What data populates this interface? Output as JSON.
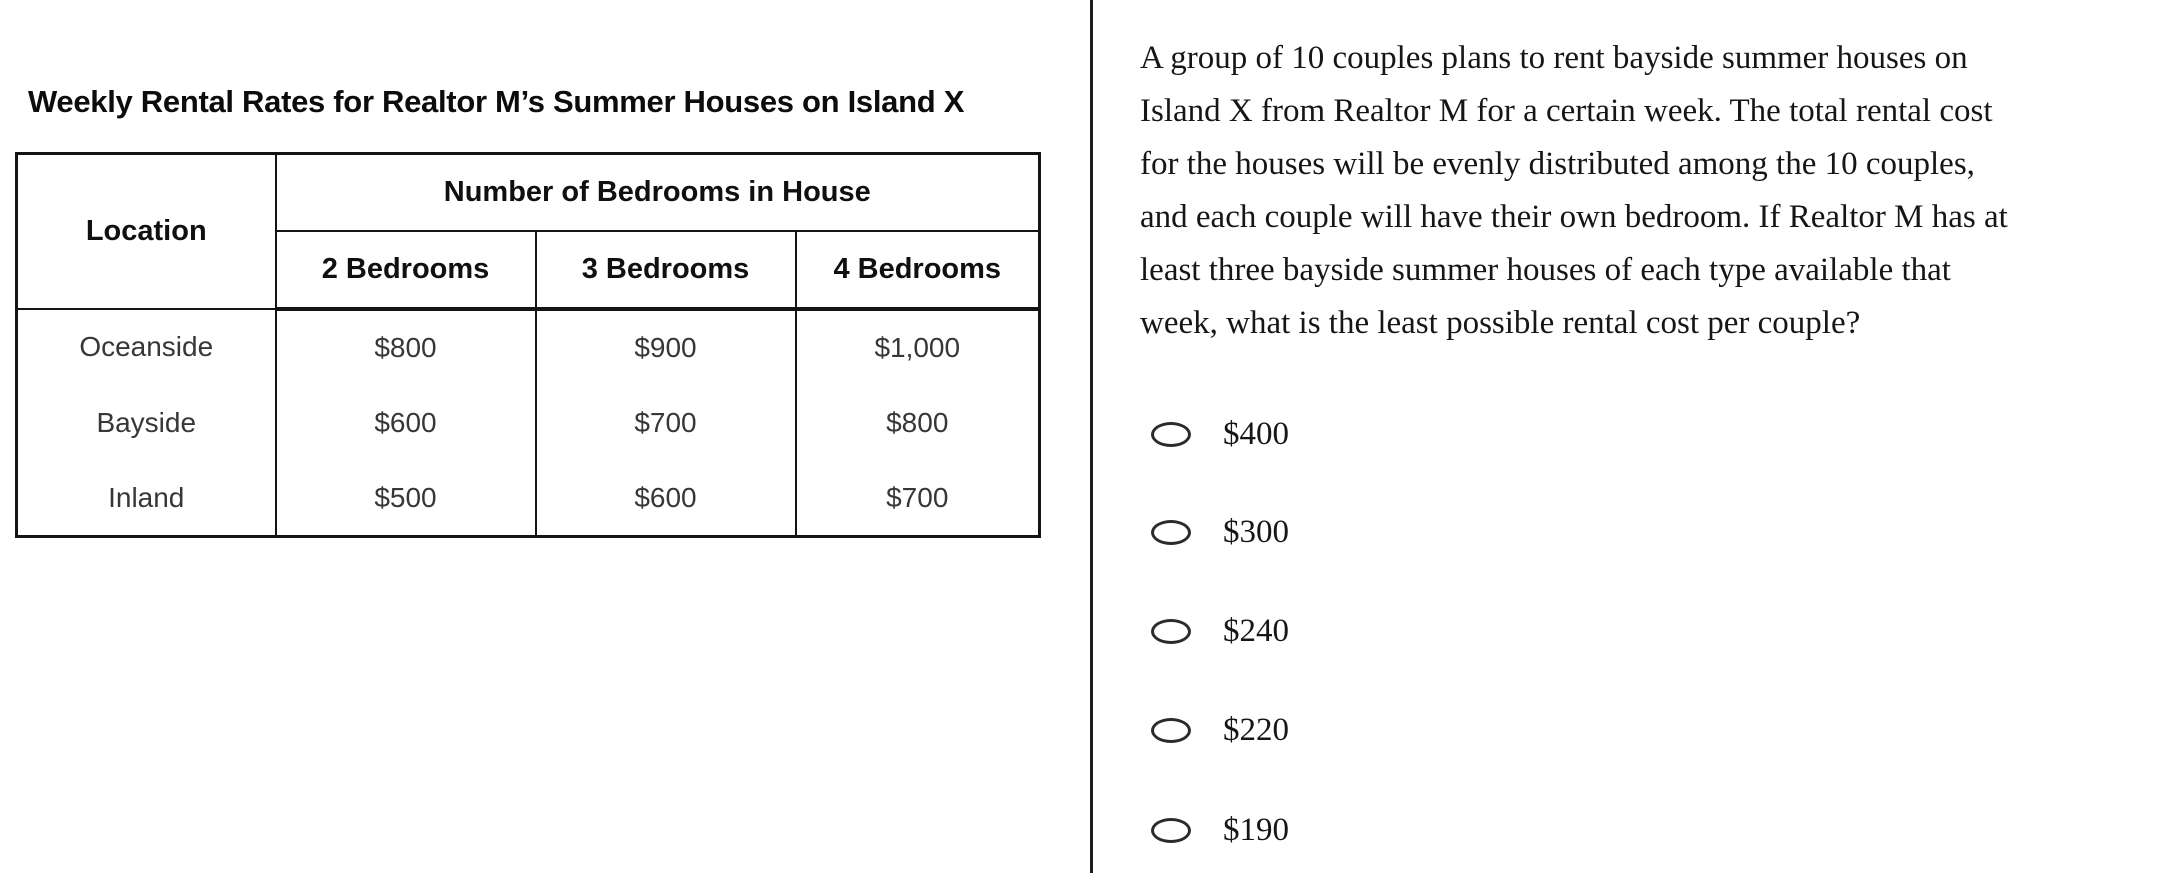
{
  "left_panel": {
    "table_title": "Weekly Rental Rates for Realtor M’s Summer Houses on Island X",
    "table": {
      "corner_header": "Location",
      "group_header": "Number of Bedrooms in House",
      "column_headers": [
        "2 Bedrooms",
        "3 Bedrooms",
        "4 Bedrooms"
      ],
      "rows": [
        {
          "location": "Oceanside",
          "values": [
            "$800",
            "$900",
            "$1,000"
          ]
        },
        {
          "location": "Bayside",
          "values": [
            "$600",
            "$700",
            "$800"
          ]
        },
        {
          "location": "Inland",
          "values": [
            "$500",
            "$600",
            "$700"
          ]
        }
      ]
    }
  },
  "right_panel": {
    "question_text": "A group of 10 couples plans to rent bayside summer houses on Island X from Realtor M for a certain week. The total rental cost for the houses will be evenly distributed among the 10 couples, and each couple will have their own bedroom. If Realtor M has at least three bayside summer houses of each type available that week, what is the least possible rental cost per couple?",
    "question_lines": [
      "A group of 10 couples plans to rent bayside summer houses on",
      "Island X from Realtor M for a certain week. The total rental cost",
      "for the houses will be evenly distributed among the 10 couples,",
      "and each couple will have their own bedroom. If Realtor M has at",
      "least three bayside summer houses of each type available that",
      "week, what is the least possible rental cost per couple?"
    ],
    "options": [
      {
        "label": "$400",
        "selected": false
      },
      {
        "label": "$300",
        "selected": false
      },
      {
        "label": "$240",
        "selected": false
      },
      {
        "label": "$220",
        "selected": false
      },
      {
        "label": "$190",
        "selected": false
      }
    ]
  },
  "chart_data": {
    "type": "table",
    "title": "Weekly Rental Rates for Realtor M’s Summer Houses on Island X",
    "row_header": "Location",
    "column_group": "Number of Bedrooms in House",
    "columns": [
      "2 Bedrooms",
      "3 Bedrooms",
      "4 Bedrooms"
    ],
    "rows": [
      {
        "location": "Oceanside",
        "values": [
          800,
          900,
          1000
        ]
      },
      {
        "location": "Bayside",
        "values": [
          600,
          700,
          800
        ]
      },
      {
        "location": "Inland",
        "values": [
          500,
          600,
          700
        ]
      }
    ]
  },
  "colors": {
    "background": "#ffffff",
    "text": "#161616",
    "table_border": "#141414",
    "divider": "#1d1d1d",
    "radio_outline": "#2b2b2b"
  }
}
